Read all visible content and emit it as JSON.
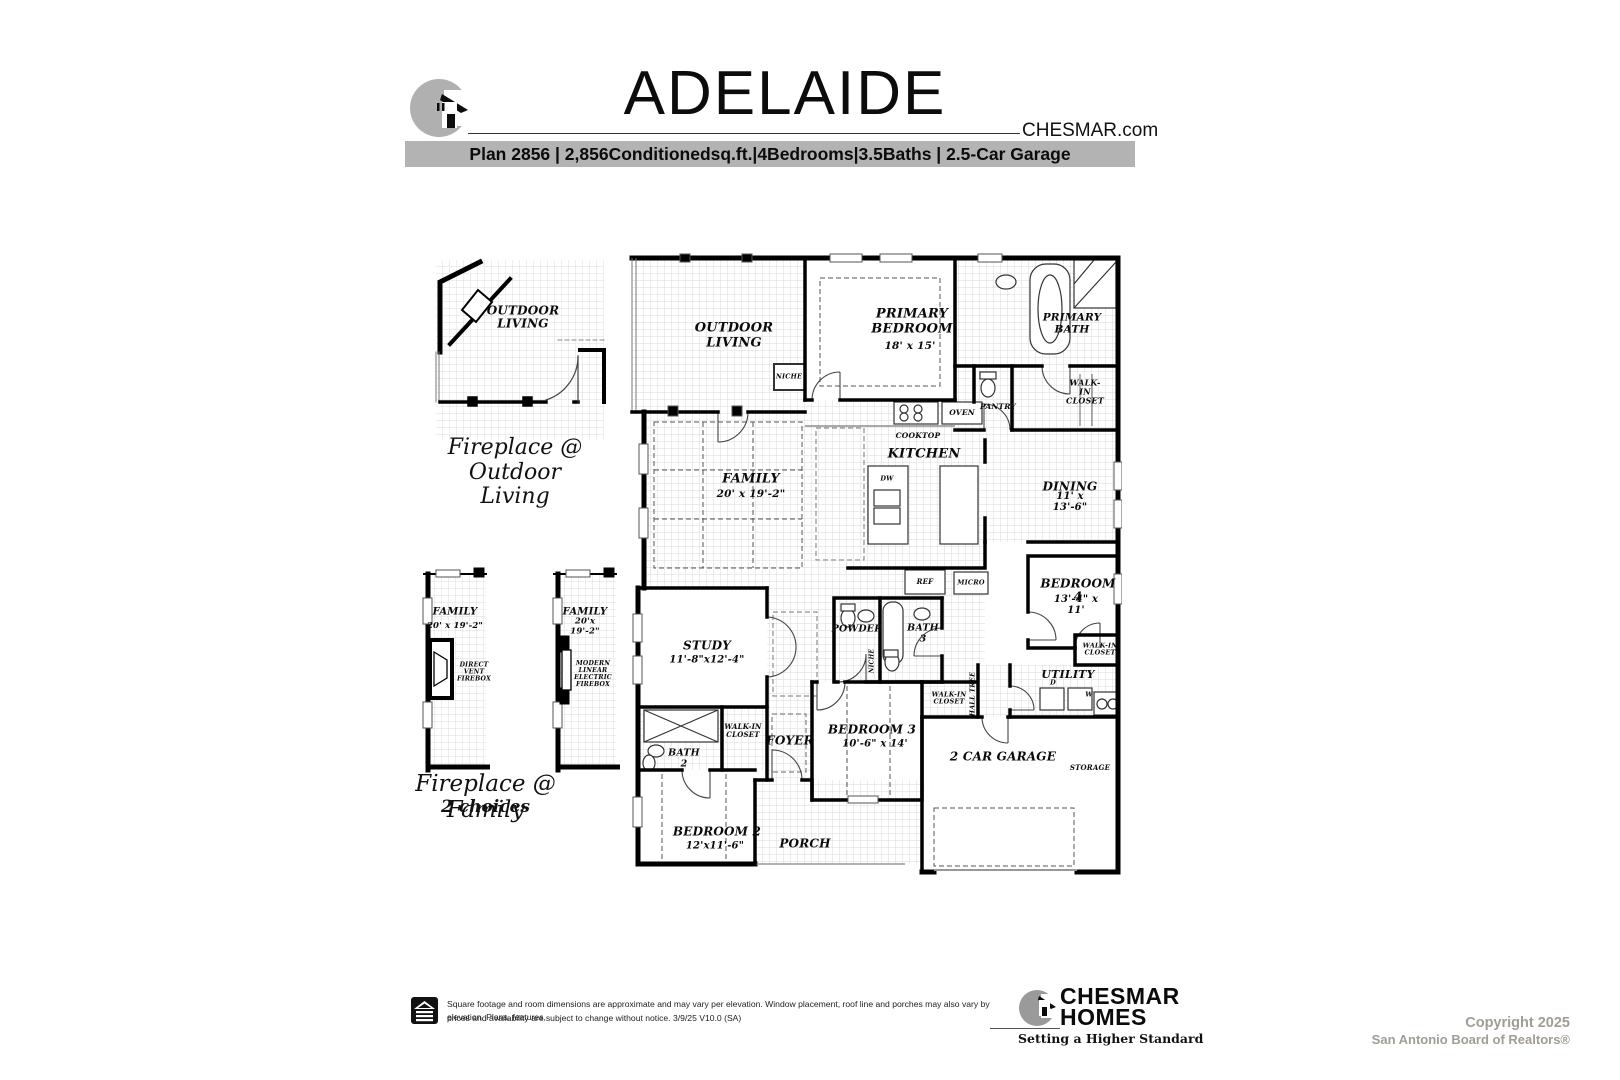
{
  "header": {
    "title": "ADELAIDE",
    "website": "CHESMAR.com",
    "specs_bar": "Plan 2856 | 2,856Conditionedsq.ft.|4Bedrooms|3.5Baths | 2.5-Car Garage"
  },
  "options": {
    "outdoor": {
      "room": "OUTDOOR\nLIVING",
      "caption": "Fireplace @\nOutdoor\nLiving"
    },
    "family_fireplace": {
      "caption": "Fireplace @ Family",
      "subcaption": "2 choices",
      "left": {
        "room": "FAMILY",
        "dims": "20' x 19'-2\"",
        "firebox": "DIRECT\nVENT\nFIREBOX"
      },
      "right": {
        "room": "FAMILY",
        "dims": "20'x 19'-2\"",
        "firebox": "MODERN\nLINEAR\nELECTRIC\nFIREBOX"
      }
    }
  },
  "plan": {
    "outdoor_living": "OUTDOOR\nLIVING",
    "primary_bedroom": "PRIMARY\nBEDROOM",
    "primary_bedroom_dims": "18' x 15'",
    "primary_bath": "PRIMARY\nBATH",
    "walkin_primary": "WALK-IN\nCLOSET",
    "pantry": "PANTRY",
    "oven": "OVEN",
    "cooktop": "COOKTOP",
    "kitchen": "KITCHEN",
    "dw": "DW",
    "dining": "DINING",
    "dining_dims": "11' x 13'-6\"",
    "family": "FAMILY",
    "family_dims": "20' x 19'-2\"",
    "niche": "NICHE",
    "ref": "REF",
    "micro": "MICRO",
    "powder": "POWDER",
    "bath3": "BATH\n3",
    "niche2": "NICHE",
    "bedroom4": "BEDROOM 4",
    "bedroom4_dims": "13'-4\" x 11'",
    "utility": "UTILITY",
    "dryer": "D",
    "washer": "W",
    "walkin_bed4": "WALK-IN\nCLOSET",
    "study": "STUDY",
    "study_dims": "11'-8\"x12'-4\"",
    "foyer": "FOYER",
    "walkin_bed2": "WALK-IN\nCLOSET",
    "bath2": "BATH\n2",
    "bedroom2": "BEDROOM 2",
    "bedroom2_dims": "12'x11'-6\"",
    "bedroom3": "BEDROOM 3",
    "bedroom3_dims": "10'-6\" x 14'",
    "walkin_bed3": "WALK-IN\nCLOSET",
    "hall_tree": "HALL TREE",
    "porch": "PORCH",
    "garage": "2 CAR GARAGE",
    "storage": "STORAGE"
  },
  "footer": {
    "disclaimer_line1": "Square footage and room dimensions are approximate and may vary per elevation. Window placement, roof line and porches may also vary by elevation. Plans, features,",
    "disclaimer_line2": "prices and availability are subject to change without notice.   3/9/25   V10.0  (SA)",
    "brand_name_line1": "CHESMAR",
    "brand_name_line2": "HOMES",
    "brand_tagline": "Setting a Higher Standard",
    "copyright_line1": "Copyright 2025",
    "copyright_line2": "San Antonio Board of Realtors®"
  }
}
